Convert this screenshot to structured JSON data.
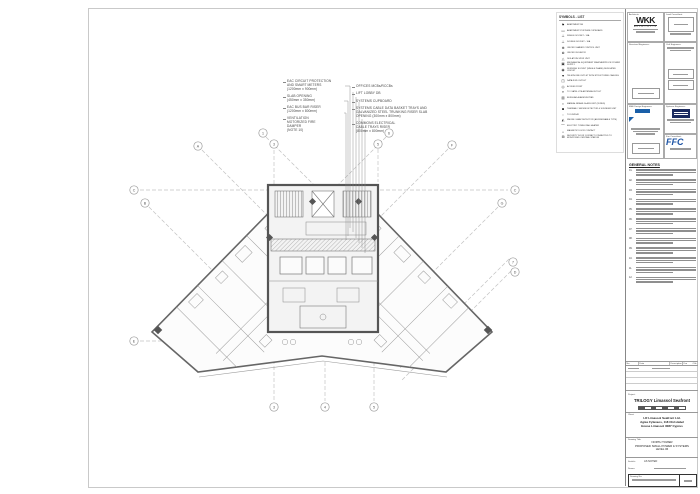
{
  "legend": {
    "title": "SYMBOLS - LIST",
    "items": [
      {
        "icon": "⚑",
        "label": "APARTMENT DB"
      },
      {
        "icon": "▭",
        "label": "APARTMENT SYSTEMS CUPBOARD"
      },
      {
        "icon": "⊥",
        "label": "SINGLE SOCKET - 16A"
      },
      {
        "icon": "⊥",
        "label": "DOUBLE SOCKET - 16A"
      },
      {
        "icon": "⊕",
        "label": "ON/OFF SHAVER CONTROL UNIT"
      },
      {
        "icon": "⊗",
        "label": "ON/OFF ISOLATOR"
      },
      {
        "icon": "△",
        "label": "ISOLATION SPUR UNIT"
      },
      {
        "icon": "▣",
        "label": "MECHANICAL EQUIPMENT WEATHERPROOF POWER SUPPLY"
      },
      {
        "icon": "◉",
        "label": "WORKING SOCKET (SINGLE PHASE) DEDICATED CIRCUIT"
      },
      {
        "icon": "▼",
        "label": "TELEPHONE OUTLET WITH STRUCTURED CABLING"
      },
      {
        "icon": "◫",
        "label": "DATA RJ45 OUTLET"
      },
      {
        "icon": "◎",
        "label": "ACCESS POINT"
      },
      {
        "icon": "¤",
        "label": "TV / SATELLITE ANTENNA OUTLET"
      },
      {
        "icon": "▥",
        "label": "BURGLAR ALARM KEYPAD"
      },
      {
        "icon": "▪",
        "label": "MANUAL BREAK GLASS UNIT (IN RED)"
      },
      {
        "icon": "◙",
        "label": "THERMAL / SMOKE DETECTOR & SOUNDER UNIT"
      },
      {
        "icon": "▫",
        "label": "TO DISPLAY"
      },
      {
        "icon": "◭",
        "label": "SMOKE / HEAT DETECTOR (ADDRESSABLE TYPE)"
      },
      {
        "icon": "⌒",
        "label": "ELECTRIC TOWEL RAIL HEATER"
      },
      {
        "icon": "⌂",
        "label": "MAGNETIC DOOR CONTACT"
      },
      {
        "icon": "⊞",
        "label": "SECURITY DOOR CONTACT CONNECTED TO MONITORED CENTRAL STATION"
      }
    ]
  },
  "annotations": {
    "left": [
      "EAC CIRCUIT PROTECTION\nAND SMART METERS\n(1200mm x 900mm)",
      "SLAB OPENING\n(450mm x 350mm)",
      "EAC BUS BAR RISER\n(1200mm x 800mm)",
      "VENTILATION\nMOTORIZED FIRE\nDAMPER\n(NOTE 10)"
    ],
    "top": [
      "OFFICES MCBs/RCCBs",
      "LIFT LOBBY DB",
      "SYSTEMS CUPBOARD",
      "SYSTEMS CABLE DATA BASKET TRAYS AND\nGALVANIZED STEEL TRUNKING RISER SLAB\nOPENING (300mm x 800mm)",
      "COMMONS ELECTRICAL\nCABLE TRAYS RISER\n(800mm x 800mm)"
    ]
  },
  "grid": {
    "bubbles": [
      {
        "label": "A",
        "x": 198,
        "y": 146
      },
      {
        "label": "B",
        "x": 145,
        "y": 203
      },
      {
        "label": "C",
        "x": 134,
        "y": 190
      },
      {
        "label": "E",
        "x": 134,
        "y": 341
      },
      {
        "label": "1",
        "x": 263,
        "y": 133
      },
      {
        "label": "3",
        "x": 274,
        "y": 144
      },
      {
        "label": "6",
        "x": 389,
        "y": 133
      },
      {
        "label": "5",
        "x": 378,
        "y": 144
      },
      {
        "label": "F",
        "x": 452,
        "y": 145
      },
      {
        "label": "C",
        "x": 515,
        "y": 190
      },
      {
        "label": "G",
        "x": 502,
        "y": 203
      },
      {
        "label": "7",
        "x": 513,
        "y": 262
      },
      {
        "label": "D",
        "x": 515,
        "y": 272
      },
      {
        "label": "3",
        "x": 274,
        "y": 407
      },
      {
        "label": "4",
        "x": 325,
        "y": 407
      },
      {
        "label": "5",
        "x": 374,
        "y": 407
      }
    ]
  },
  "titleblock": {
    "labels": {
      "architects": "Architects:",
      "lead": "Lead Consultant:",
      "structural": "Structural Engineers:",
      "civil": "Civil Engineers:",
      "mep": "M&E Design Engineers:",
      "systems": "Systems Engineers:",
      "fire": "Fire Consultant:"
    },
    "wkk": "WKK",
    "wkk_sub": "ARCHITECTS",
    "ffc": "FFC",
    "general_notes": {
      "title": "GENERAL NOTES",
      "numbers": [
        "01.",
        "02.",
        "03.",
        "04.",
        "05.",
        "06.",
        "07.",
        "08.",
        "09.",
        "10.",
        "11.",
        "12."
      ]
    },
    "revisions": {
      "headers": [
        "No.",
        "Date",
        "Description",
        "Drn",
        "Chk"
      ]
    },
    "project": {
      "label": "Project:",
      "name": "TRILOGY Limassol Seafront"
    },
    "client": {
      "label": "Client:",
      "lines": [
        "LR Limassol Seafront Ltd.",
        "Agias Fylaxeos, 118 Christabel",
        "House Limassol 3087 Cyprus"
      ]
    },
    "drawing": {
      "label": "Drawing Title:",
      "lines": [
        "NORTH TOWER",
        "PROPOSED SMALL POWER & SYSTEMS",
        "LEVEL 06"
      ]
    },
    "meta": {
      "scale_label": "Scale/s:",
      "scale": "AS NOTED",
      "drawn_label": "Drawn:"
    },
    "number_label": "Drawing No:"
  }
}
